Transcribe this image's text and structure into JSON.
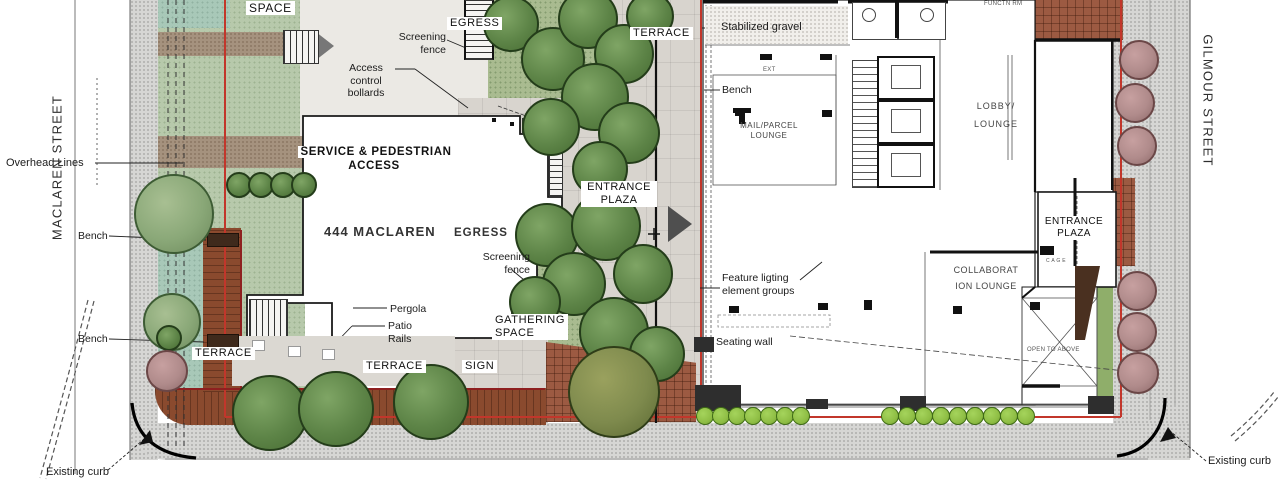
{
  "title": "444 Maclaren site plan",
  "streets": {
    "left": "MACLAREN STREET",
    "right": "GILMOUR STREET"
  },
  "labels": {
    "space": "SPACE",
    "egress_top": "EGRESS",
    "screening_fence_top": "Screening\nfence",
    "access_bollards": "Access\ncontrol\nbollards",
    "terrace_top": "TERRACE",
    "stabilized_gravel": "Stabilized gravel",
    "ext": "EXT",
    "functn_rm": "FUNCTN RM",
    "bench_interior": "Bench",
    "mail_parcel": "MAIL/PARCEL\nLOUNGE",
    "lobby": "LOBBY/\nLOUNGE",
    "overhead_lines": "Overhead Lines",
    "service_access": "SERVICE & PEDESTRIAN\nACCESS",
    "entrance_plaza": "ENTRANCE\nPLAZA",
    "maclaren_444": "444 MACLAREN",
    "egress_mid": "EGRESS",
    "screening_fence_mid": "Screening\nfence",
    "bench_upper": "Bench",
    "entrance_plaza_right": "ENTRANCE\nPLAZA",
    "cage": "C A G E",
    "feature_lighting": "Feature ligting\nelement groups",
    "collab_lounge": "COLLABORAT\nION LOUNGE",
    "pergola": "Pergola",
    "patio_rails": "Patio\nRails",
    "gathering_space": "GATHERING\nSPACE",
    "seating_wall": "Seating wall",
    "bench_lower": "Bench",
    "terrace_left": "TERRACE",
    "terrace_mid": "TERRACE",
    "sign": "SIGN",
    "open_above": "OPEN TO ABOVE",
    "existing_curb_left": "Existing curb",
    "existing_curb_right": "Existing curb"
  },
  "colors": {
    "property_line_red": "#c2362b",
    "deck_brown": "#8a4a2e",
    "brick": "#9c5a42",
    "lawn_green": "#b7c9ab",
    "tree_green": "#5d8447",
    "tree_pink": "#b08b8b",
    "hedge_green": "#8fbe45",
    "plaza_gray": "#d8d4ce",
    "sidewalk_gray": "#d6d6d4",
    "teal_planting": "#a8c8b8",
    "path_brown": "#a5927e"
  }
}
